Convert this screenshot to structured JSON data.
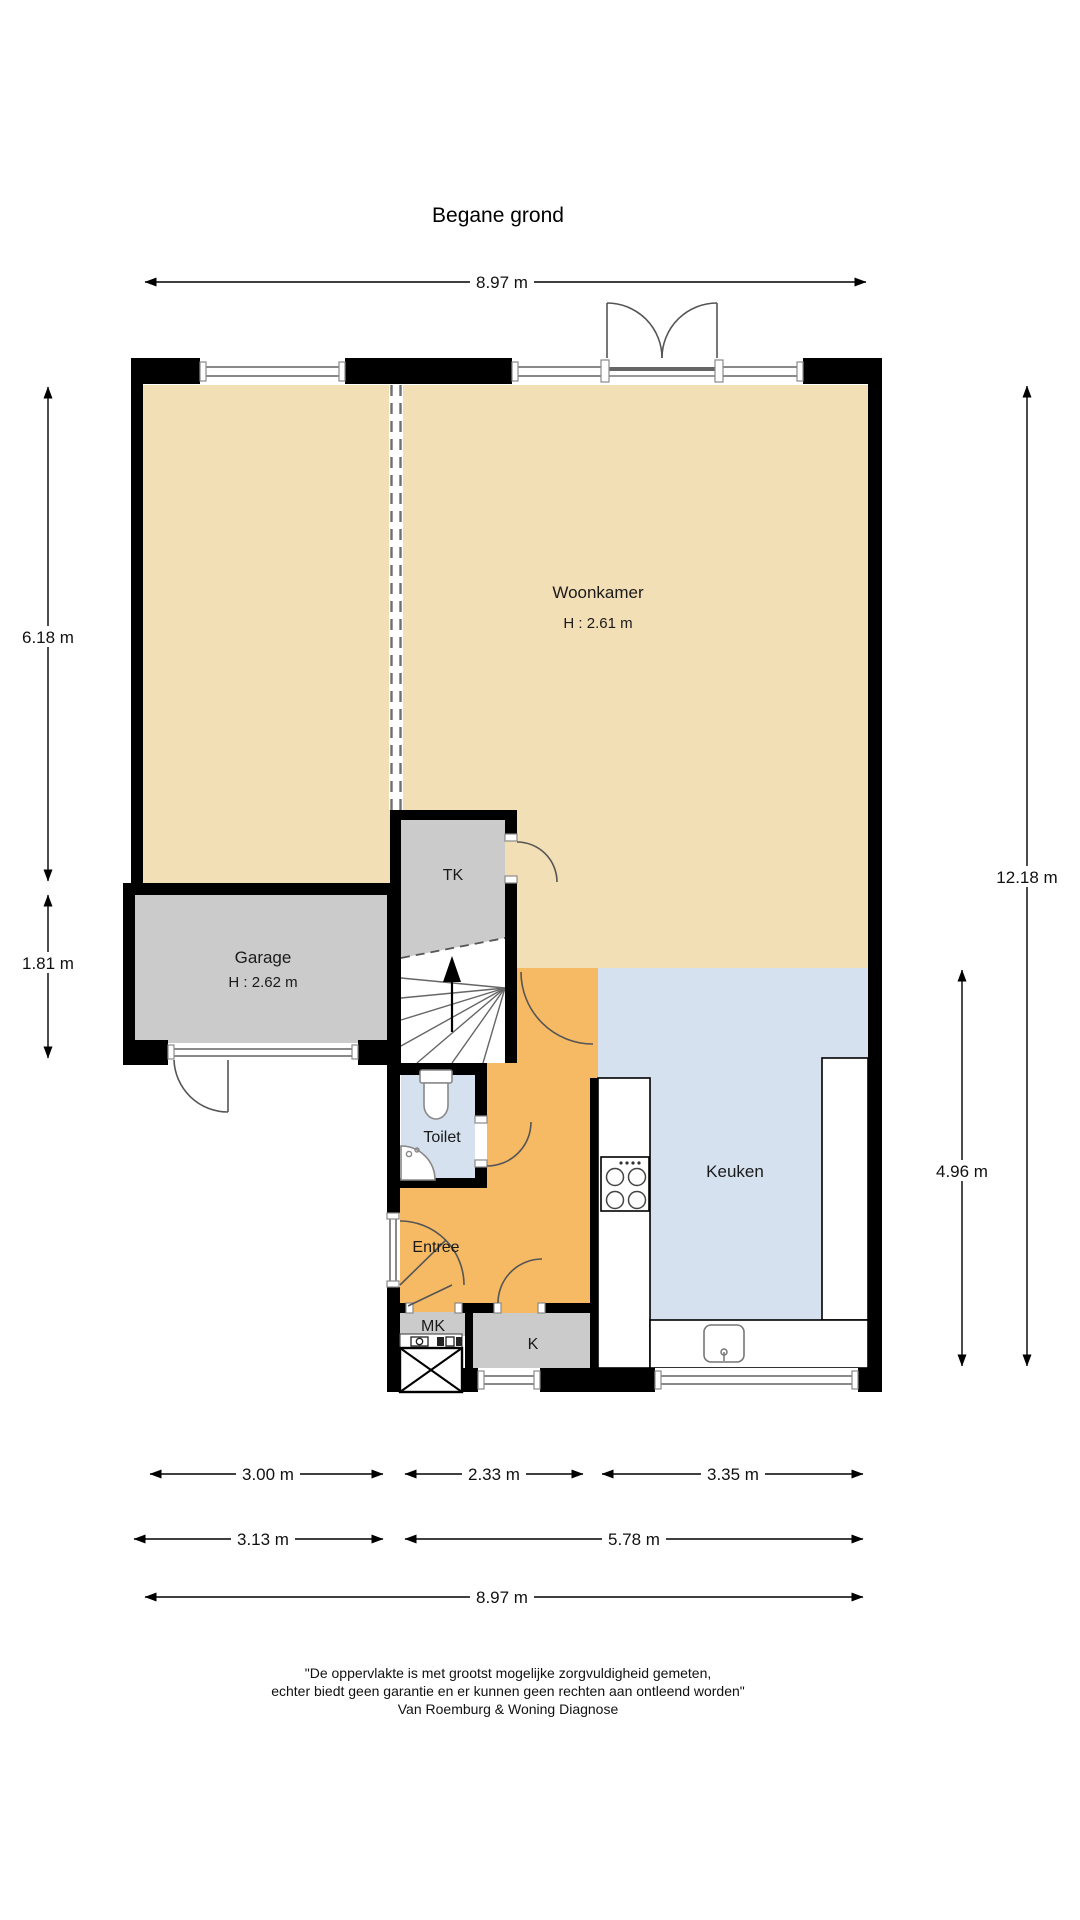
{
  "page": {
    "title": "Begane grond"
  },
  "rooms": {
    "woonkamer": {
      "label": "Woonkamer",
      "height": "H : 2.61 m"
    },
    "garage": {
      "label": "Garage",
      "height": "H : 2.62 m"
    },
    "tk": {
      "label": "TK"
    },
    "toilet": {
      "label": "Toilet"
    },
    "entree": {
      "label": "Entree"
    },
    "keuken": {
      "label": "Keuken"
    },
    "mk": {
      "label": "MK"
    },
    "k": {
      "label": "K"
    }
  },
  "dimensions": {
    "top_total": "8.97 m",
    "left_upper": "6.18 m",
    "left_lower": "1.81 m",
    "right_total": "12.18 m",
    "right_lower": "4.96 m",
    "bottom_row1": [
      "3.00 m",
      "2.33 m",
      "3.35 m"
    ],
    "bottom_row2": [
      "3.13 m",
      "5.78 m"
    ],
    "bottom_total": "8.97 m"
  },
  "footer": {
    "line1": "\"De oppervlakte is met grootst mogelijke zorgvuldigheid gemeten,",
    "line2": "echter biedt geen garantie en er kunnen geen rechten aan ontleend worden\"",
    "line3": "Van Roemburg & Woning Diagnose"
  },
  "colors": {
    "floor_living": "#F3DFB6",
    "floor_hall": "#F6BA65",
    "floor_wet": "#D5E1EF",
    "floor_storage": "#CBCBCB",
    "wall": "#000000"
  }
}
